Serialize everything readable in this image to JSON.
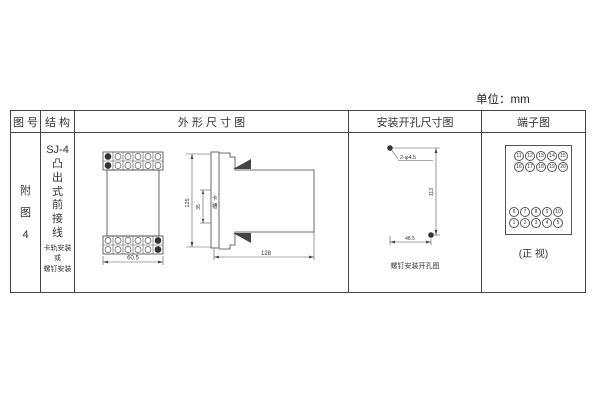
{
  "units_label": "单位：mm",
  "table": {
    "headers": {
      "fig_no": "图 号",
      "structure": "结 构",
      "outline": "外 形 尺 寸 图",
      "mounting": "安装开孔尺寸图",
      "terminal": "端子图"
    }
  },
  "fig_col": {
    "label": "附\n图\n4"
  },
  "structure_col": {
    "model": "SJ-4",
    "type_vertical": "凸\n出\n式\n前\n接\n线",
    "mount_note": "卡轨安装\n或\n螺钉安装"
  },
  "outline": {
    "front": {
      "width_dim": "60.5"
    },
    "side": {
      "height_dim": "125",
      "slot_dim": "35",
      "slot_label": "卡\n槽",
      "depth_dim": "128"
    }
  },
  "mounting": {
    "hole_label": "2-φ4.5",
    "v_dim": "113",
    "h_dim": "48.5",
    "caption": "螺钉安装开孔图"
  },
  "terminal": {
    "top_rows": [
      [
        "11",
        "12",
        "13",
        "14",
        "15"
      ],
      [
        "16",
        "17",
        "18",
        "19",
        "20"
      ]
    ],
    "bottom_rows": [
      [
        "6",
        "7",
        "8",
        "9",
        "10"
      ],
      [
        "1",
        "2",
        "3",
        "4",
        "5"
      ]
    ],
    "caption": "(正 视)"
  }
}
